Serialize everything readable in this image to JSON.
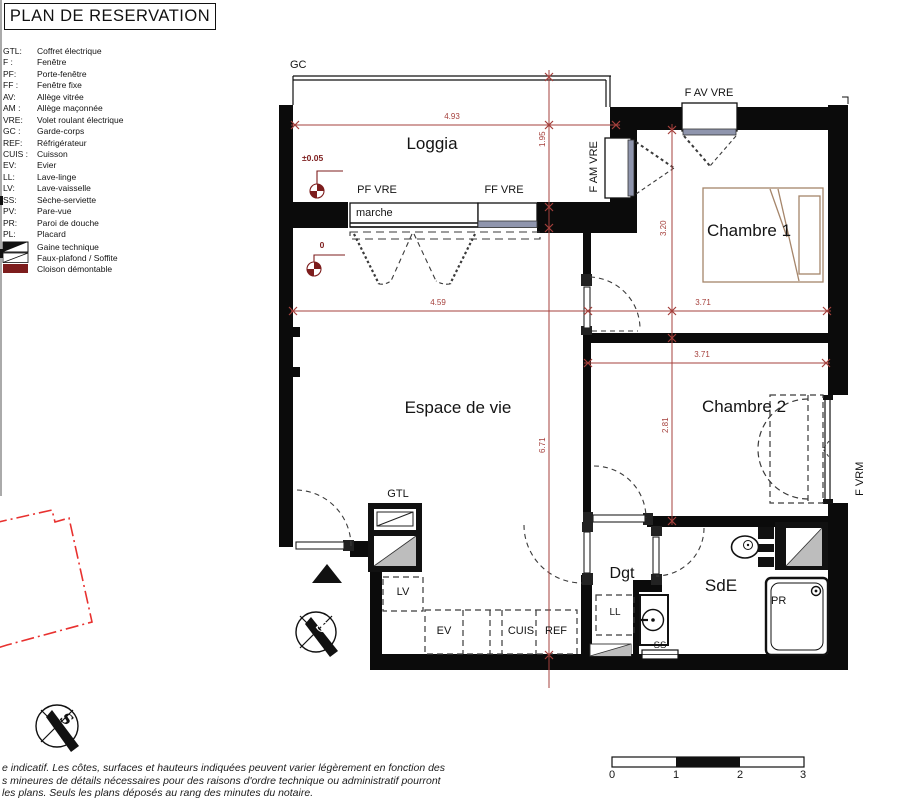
{
  "title": "PLAN DE RESERVATION",
  "legend": {
    "items": [
      {
        "k": "GTL:",
        "v": "Coffret électrique"
      },
      {
        "k": "F :",
        "v": "Fenêtre"
      },
      {
        "k": "PF:",
        "v": "Porte-fenêtre"
      },
      {
        "k": "FF :",
        "v": "Fenêtre fixe"
      },
      {
        "k": "AV:",
        "v": "Allège vitrée"
      },
      {
        "k": "AM :",
        "v": "Allège maçonnée"
      },
      {
        "k": "VRE:",
        "v": "Volet roulant électrique"
      },
      {
        "k": "GC :",
        "v": "Garde-corps"
      },
      {
        "k": "REF:",
        "v": "Réfrigérateur"
      },
      {
        "k": "CUIS :",
        "v": "Cuisson"
      },
      {
        "k": "EV:",
        "v": "Evier"
      },
      {
        "k": "LL:",
        "v": "Lave-linge"
      },
      {
        "k": "LV:",
        "v": "Lave-vaisselle"
      },
      {
        "k": "SS:",
        "v": "Sèche-serviette"
      },
      {
        "k": "PV:",
        "v": "Pare-vue"
      },
      {
        "k": "PR:",
        "v": "Paroi de douche"
      },
      {
        "k": "PL:",
        "v": "Placard"
      }
    ],
    "symbols": [
      "Gaine technique",
      "Faux-plafond / Soffite",
      "Cloison démontable"
    ]
  },
  "rooms": {
    "loggia": "Loggia",
    "living": "Espace de vie",
    "bedroom1": "Chambre 1",
    "bedroom2": "Chambre 2",
    "hallway": "Dgt",
    "bathroom": "SdE"
  },
  "features": {
    "gc": "GC",
    "pf_vre": "PF VRE",
    "ff_vre": "FF VRE",
    "marche": "marche",
    "f_am_vre": "F AM VRE",
    "f_av_vre": "F AV VRE",
    "f_vrm": "F VRM",
    "gtl": "GTL",
    "lv": "LV",
    "ev": "EV",
    "cuis": "CUIS",
    "ref": "REF",
    "ll": "LL",
    "ss": "SS",
    "pr": "PR"
  },
  "dims": {
    "loggia_w": "4.93",
    "loggia_d": "1.95",
    "living_w": "4.59",
    "living_h": "6.71",
    "bedroom1_w": "3.71",
    "bedroom1_h": "3.20",
    "bedroom2_w": "3.71",
    "bedroom2_h": "2.81"
  },
  "levels": {
    "loggia": "±0.05",
    "living": "0"
  },
  "compass": {
    "letter": "S"
  },
  "scale": {
    "t0": "0",
    "t1": "1",
    "t2": "2",
    "t3": "3"
  },
  "footer": {
    "line1": "e indicatif. Les côtes, surfaces et hauteurs indiquées peuvent varier légèrement en fonction des",
    "line2": "s mineures de détails nécessaires pour des raisons d'ordre technique ou administratif pourront",
    "line3": "les plans. Seuls les plans déposés au rang des minutes du notaire."
  },
  "colors": {
    "wall": "#0B0B0B",
    "dim_red": "#A5403C",
    "level_red": "#7D1D1D",
    "parcel_red": "#E8312F",
    "glazing_slate": "#8F95AD",
    "gaine_gray": "#BDBDBD",
    "furniture_tan": "#A5856A"
  }
}
